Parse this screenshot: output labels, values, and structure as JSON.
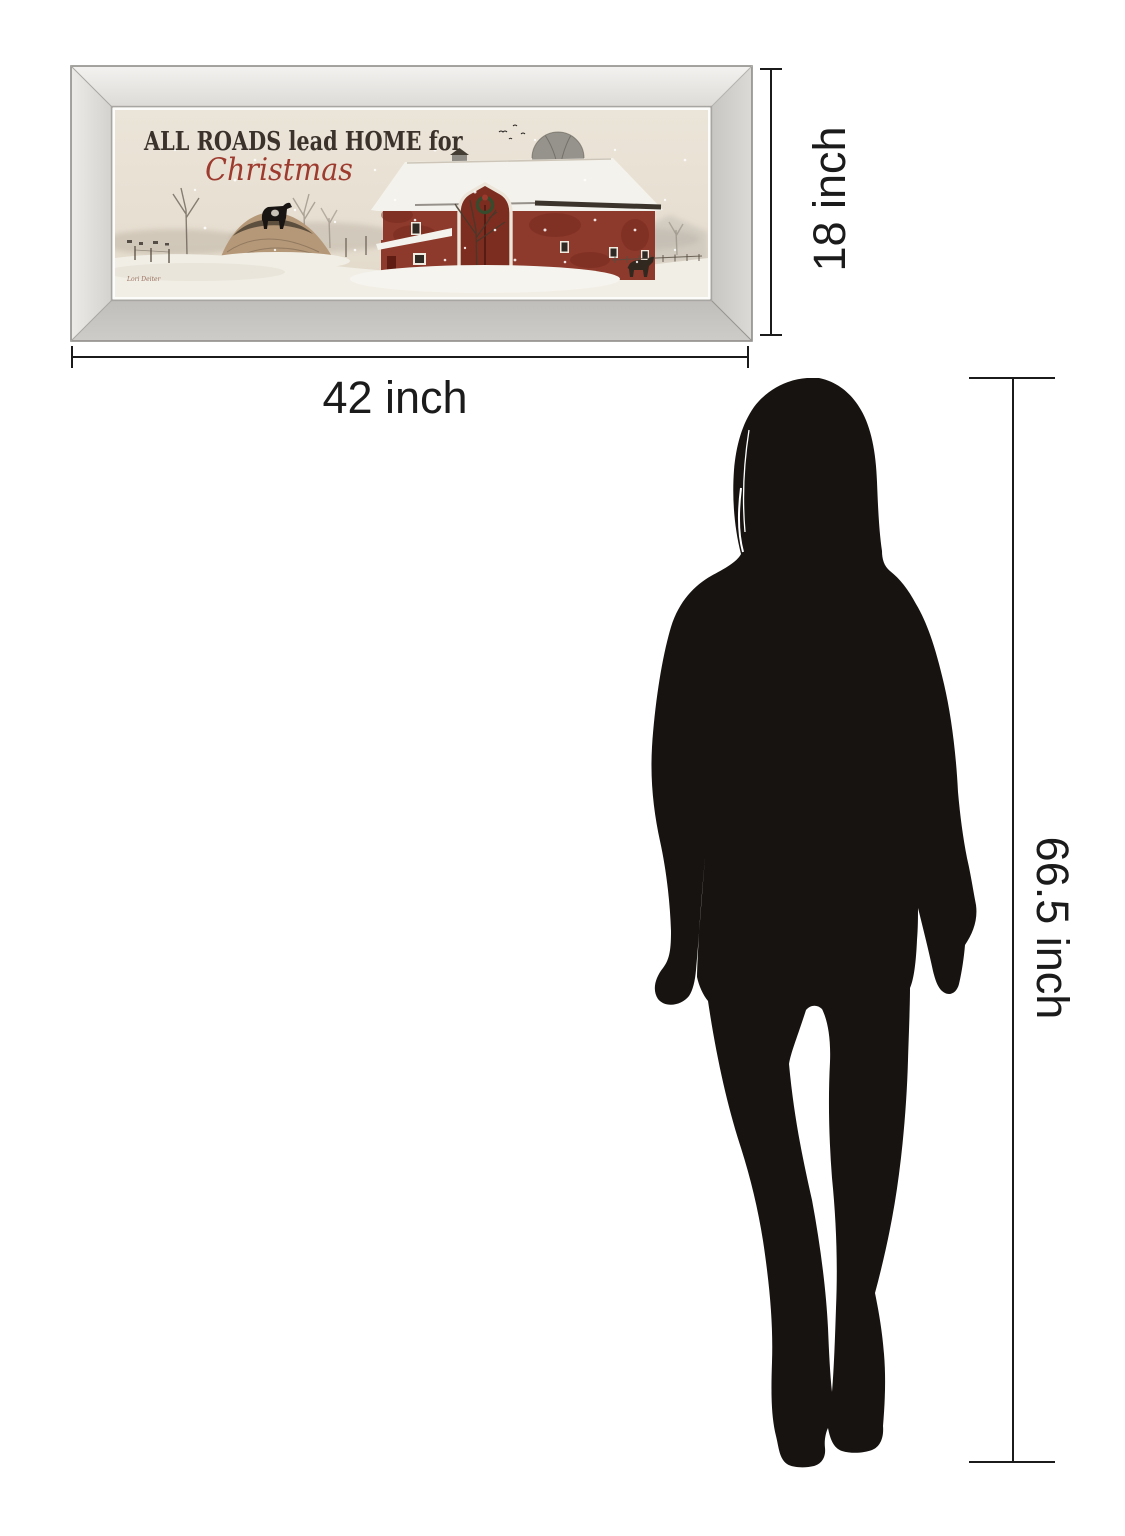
{
  "page": {
    "background": "#ffffff"
  },
  "artwork": {
    "title_line1": "ALL ROADS lead HOME for",
    "title_line2": "Christmas",
    "signature": "Lori Deiter",
    "subject": "red barn winter scene with silo, snow, cow on mound and bare trees"
  },
  "dimensions": {
    "width": {
      "label": "42 inch"
    },
    "height": {
      "label": "18 inch"
    },
    "person_height": {
      "label": "66.5 inch"
    }
  },
  "silhouette": {
    "description": "standing woman silhouette used for scale"
  },
  "colors": {
    "frame_silver": "#d9d7d3",
    "art_sky": "#e9e2d5",
    "barn_red": "#8d392b",
    "title_text": "#3b332b",
    "script_red": "#9e3b2f",
    "dimension_ink": "#1b1b1b",
    "silhouette_black": "#171310"
  }
}
